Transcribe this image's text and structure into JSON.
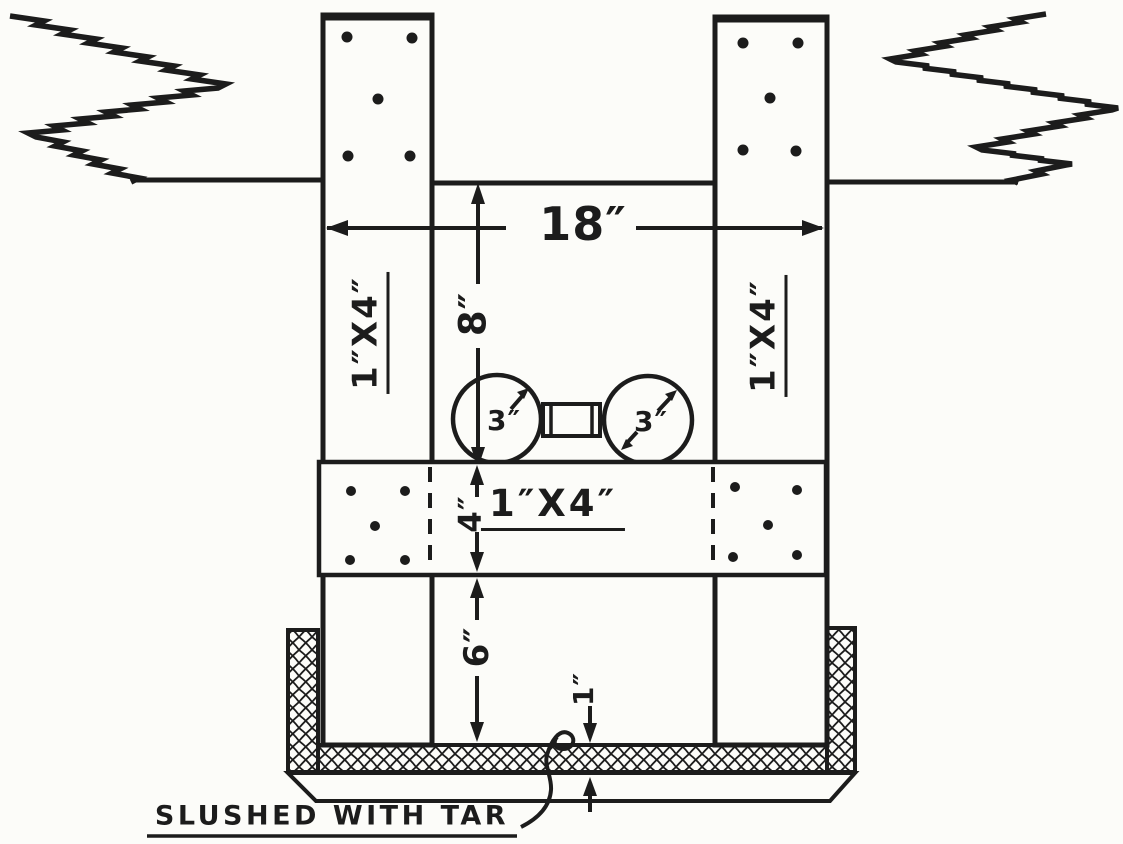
{
  "figure": {
    "colors": {
      "ink": "#1c1c1c",
      "paper": "#fcfcf9"
    },
    "labels": {
      "dim_width": "18″",
      "dim_depth": "8″",
      "left_post": "1″X4″",
      "right_post": "1″X4″",
      "left_pipe_dia": "3″",
      "right_pipe_dia": "3″",
      "cross_board": "1″X4″",
      "dim_board": "4″",
      "dim_lower": "6″",
      "dim_bottom": "1″",
      "caption": "SLUSHED WITH TAR"
    }
  }
}
